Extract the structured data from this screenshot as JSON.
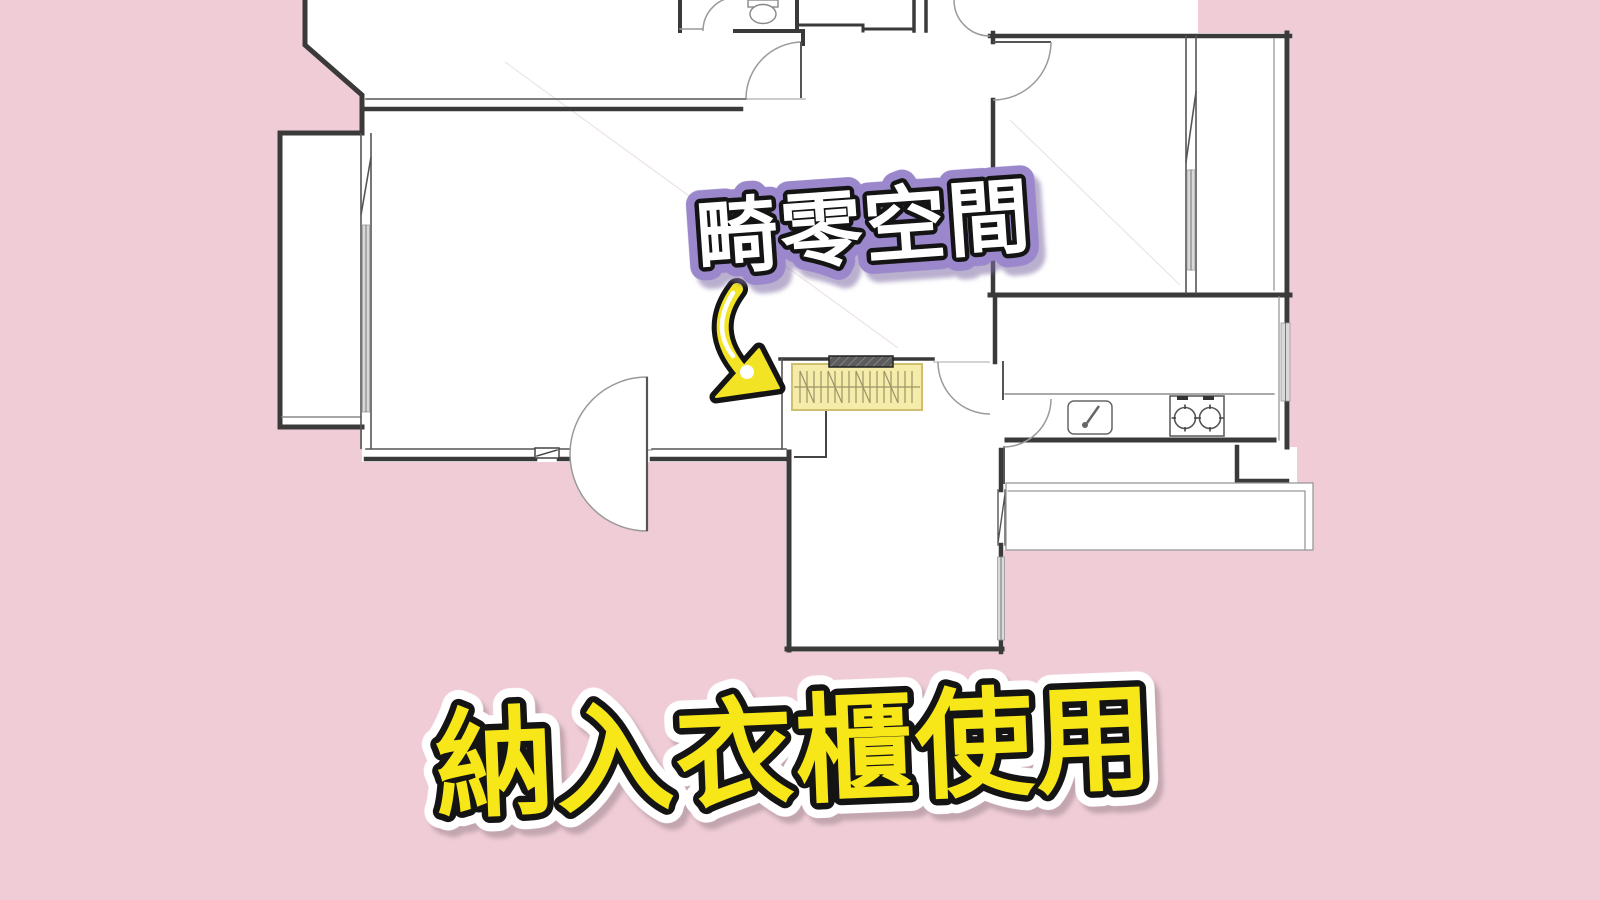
{
  "canvas": {
    "width": 1600,
    "height": 900
  },
  "colors": {
    "background": "#f0cdd6",
    "plan_fill": "#ffffff",
    "wall": "#3a3a3a",
    "label_text_fill": "#ffffff",
    "label_outline_purple": "#9b87cb",
    "title_yellow": "#f7e618",
    "arrow_yellow": "#f2e424",
    "wardrobe_yellow": "#f5ecaa"
  },
  "callout": {
    "label": "畸零空間"
  },
  "caption": {
    "text": "納入衣櫃使用"
  },
  "icons": {
    "arrow": "curved-arrow-down-right-icon",
    "fixtures": [
      "toilet-icon",
      "sink-icon",
      "stove-icon",
      "wardrobe-hanging-rail-icon"
    ]
  }
}
